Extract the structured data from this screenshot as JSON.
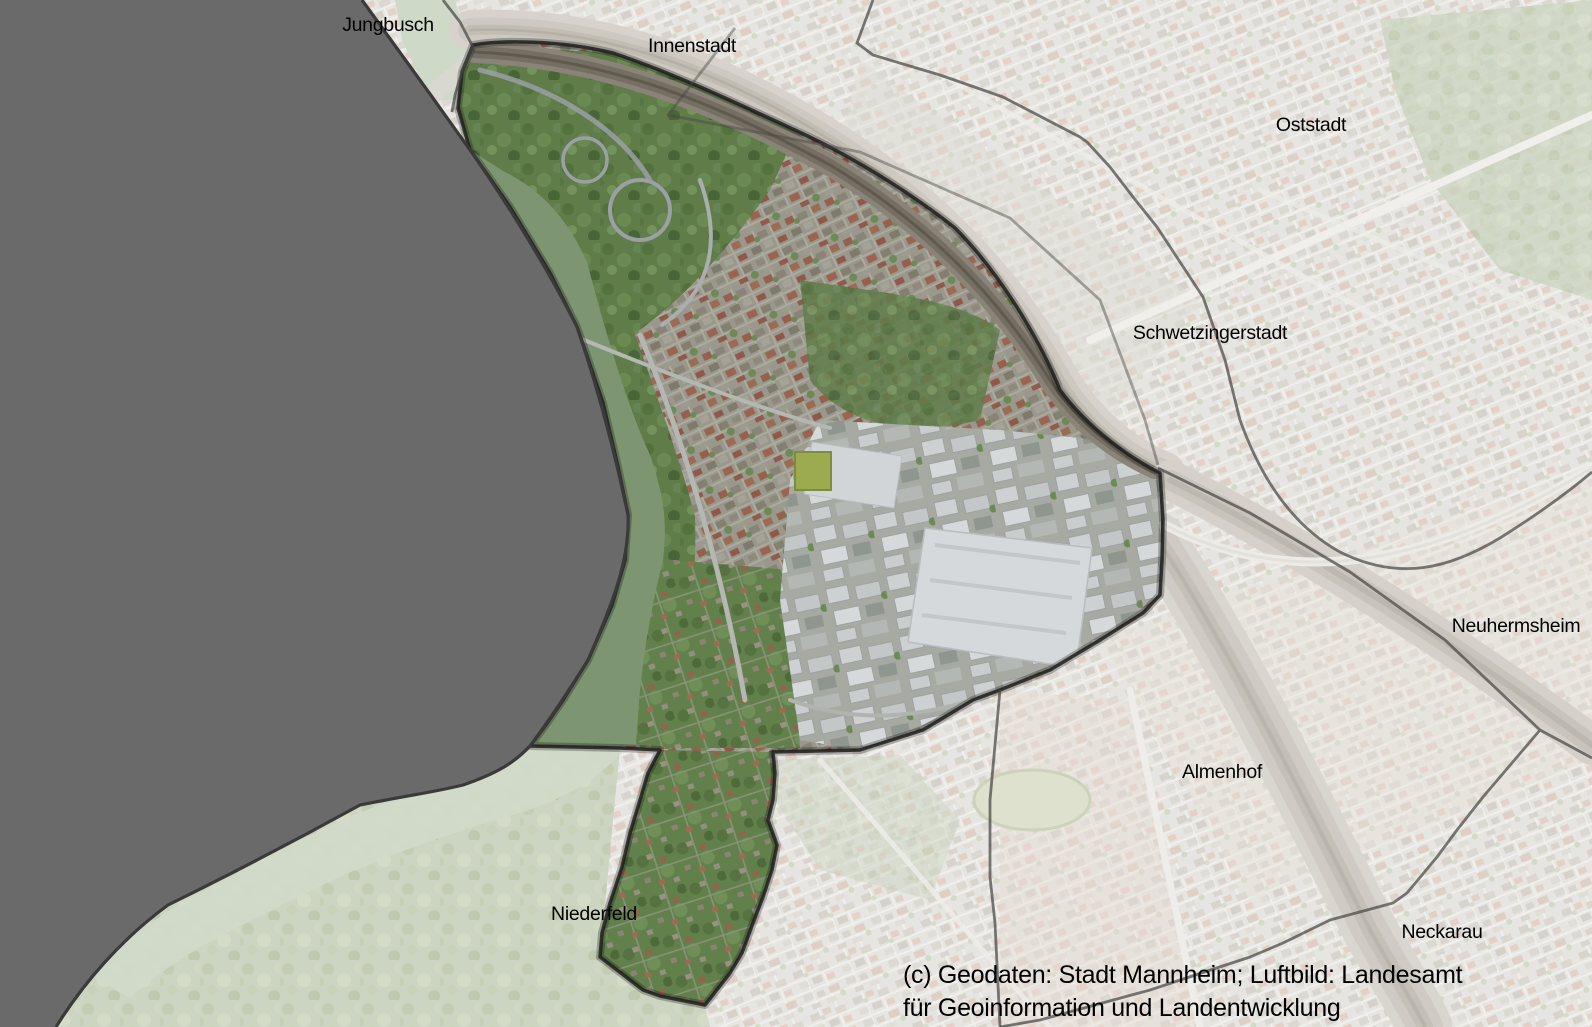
{
  "map": {
    "kind": "aerial-district-map",
    "labels": {
      "jungbusch": "Jungbusch",
      "innenstadt": "Innenstadt",
      "oststadt": "Oststadt",
      "schwetzingerstadt": "Schwetzingerstadt",
      "neuhermsheim": "Neuhermsheim",
      "almenhof": "Almenhof",
      "neckarau": "Neckarau",
      "niederfeld": "Niederfeld"
    },
    "attribution": {
      "line1": "(c) Geodaten: Stadt Mannheim; Luftbild: Landesamt",
      "line2": "für Geoinformation und Landentwicklung"
    },
    "colors": {
      "outside_mask": "#6a6a6a",
      "mask_edge": "#3a3a3a",
      "boundary_line": "#464644",
      "river_highlight": "#7d9571",
      "river_faded": "#ccd7c6",
      "faded_base": "#e6e5e1",
      "label_text": "#000000"
    }
  }
}
